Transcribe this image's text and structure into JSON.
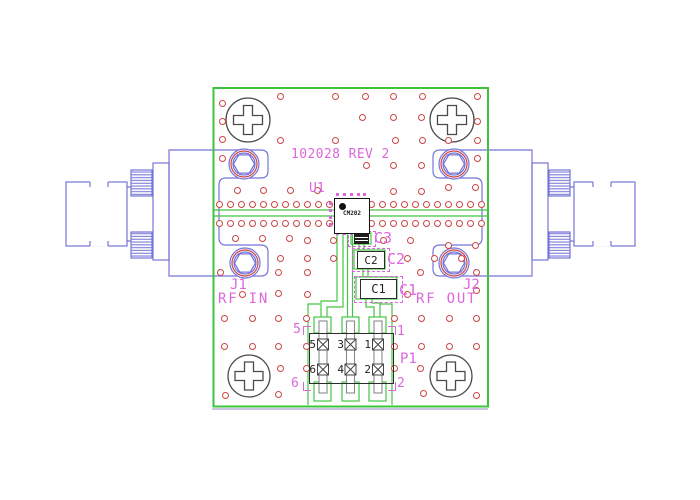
{
  "board": {
    "silkscreen_title": "102028 REV 2",
    "colors": {
      "board_outline": "#3cc43c",
      "trace": "#44c444",
      "silkscreen": "#dd66dd",
      "via_ring": "#cc4545",
      "connector_blue": "#7474d8",
      "component_dark": "#2b2b2b",
      "board_layer2": "#a8a8d4"
    }
  },
  "components": {
    "u1": {
      "ref": "U1",
      "part": "CM202"
    },
    "c1": {
      "ref": "C1",
      "body_text": "C1"
    },
    "c2": {
      "ref": "C2",
      "body_text": "C2"
    },
    "c3": {
      "ref": "C3"
    },
    "p1": {
      "ref": "P1",
      "pin_numbers": [
        "5",
        "3",
        "1",
        "6",
        "4",
        "2"
      ],
      "silk_pins": {
        "top_left": "5",
        "bottom_left": "6",
        "top_right": "1",
        "bottom_right": "2"
      }
    },
    "j1": {
      "ref": "J1",
      "label": "RF IN"
    },
    "j2": {
      "ref": "J2",
      "label": "RF OUT"
    }
  },
  "vias": [
    [
      222,
      103
    ],
    [
      222,
      121
    ],
    [
      222,
      139
    ],
    [
      222,
      158
    ],
    [
      280,
      96
    ],
    [
      335,
      96
    ],
    [
      365,
      96
    ],
    [
      393,
      96
    ],
    [
      422,
      96
    ],
    [
      477,
      96
    ],
    [
      362,
      117
    ],
    [
      393,
      117
    ],
    [
      421,
      117
    ],
    [
      477,
      121
    ],
    [
      280,
      140
    ],
    [
      335,
      140
    ],
    [
      395,
      140
    ],
    [
      422,
      140
    ],
    [
      448,
      140
    ],
    [
      477,
      140
    ],
    [
      477,
      158
    ],
    [
      366,
      165
    ],
    [
      393,
      165
    ],
    [
      421,
      165
    ],
    [
      237,
      190
    ],
    [
      263,
      190
    ],
    [
      290,
      190
    ],
    [
      317,
      190
    ],
    [
      393,
      191
    ],
    [
      421,
      191
    ],
    [
      448,
      187
    ],
    [
      475,
      187
    ],
    [
      219,
      204
    ],
    [
      230,
      204
    ],
    [
      241,
      204
    ],
    [
      252,
      204
    ],
    [
      263,
      204
    ],
    [
      274,
      204
    ],
    [
      285,
      204
    ],
    [
      296,
      204
    ],
    [
      307,
      204
    ],
    [
      318,
      204
    ],
    [
      329,
      204
    ],
    [
      371,
      204
    ],
    [
      382,
      204
    ],
    [
      393,
      204
    ],
    [
      404,
      204
    ],
    [
      415,
      204
    ],
    [
      426,
      204
    ],
    [
      437,
      204
    ],
    [
      448,
      204
    ],
    [
      459,
      204
    ],
    [
      470,
      204
    ],
    [
      481,
      204
    ],
    [
      219,
      223
    ],
    [
      230,
      223
    ],
    [
      241,
      223
    ],
    [
      252,
      223
    ],
    [
      263,
      223
    ],
    [
      274,
      223
    ],
    [
      285,
      223
    ],
    [
      296,
      223
    ],
    [
      307,
      223
    ],
    [
      318,
      223
    ],
    [
      329,
      223
    ],
    [
      371,
      223
    ],
    [
      382,
      223
    ],
    [
      393,
      223
    ],
    [
      404,
      223
    ],
    [
      415,
      223
    ],
    [
      426,
      223
    ],
    [
      437,
      223
    ],
    [
      448,
      223
    ],
    [
      459,
      223
    ],
    [
      470,
      223
    ],
    [
      481,
      223
    ],
    [
      235,
      238
    ],
    [
      262,
      238
    ],
    [
      289,
      238
    ],
    [
      307,
      240
    ],
    [
      333,
      240
    ],
    [
      383,
      240
    ],
    [
      410,
      240
    ],
    [
      448,
      245
    ],
    [
      475,
      245
    ],
    [
      280,
      258
    ],
    [
      307,
      258
    ],
    [
      333,
      258
    ],
    [
      407,
      258
    ],
    [
      434,
      258
    ],
    [
      461,
      258
    ],
    [
      220,
      272
    ],
    [
      278,
      272
    ],
    [
      307,
      272
    ],
    [
      420,
      272
    ],
    [
      476,
      272
    ],
    [
      242,
      294
    ],
    [
      278,
      293
    ],
    [
      307,
      294
    ],
    [
      407,
      294
    ],
    [
      476,
      290
    ],
    [
      224,
      318
    ],
    [
      252,
      318
    ],
    [
      278,
      318
    ],
    [
      306,
      318
    ],
    [
      394,
      318
    ],
    [
      421,
      318
    ],
    [
      449,
      318
    ],
    [
      476,
      318
    ],
    [
      224,
      346
    ],
    [
      252,
      346
    ],
    [
      278,
      346
    ],
    [
      306,
      346
    ],
    [
      394,
      346
    ],
    [
      421,
      346
    ],
    [
      449,
      346
    ],
    [
      476,
      346
    ],
    [
      280,
      368
    ],
    [
      306,
      368
    ],
    [
      394,
      368
    ],
    [
      420,
      368
    ],
    [
      225,
      395
    ],
    [
      278,
      394
    ],
    [
      423,
      393
    ],
    [
      476,
      395
    ]
  ],
  "u1_pads": [
    [
      337,
      194
    ],
    [
      344,
      194
    ],
    [
      351,
      194
    ],
    [
      358,
      194
    ],
    [
      364,
      194
    ],
    [
      337,
      233
    ],
    [
      344,
      233
    ],
    [
      351,
      233
    ],
    [
      358,
      233
    ],
    [
      364,
      233
    ],
    [
      330,
      203
    ],
    [
      330,
      210
    ],
    [
      330,
      217
    ],
    [
      330,
      224
    ],
    [
      367,
      203
    ],
    [
      367,
      210
    ],
    [
      367,
      217
    ],
    [
      367,
      224
    ]
  ]
}
